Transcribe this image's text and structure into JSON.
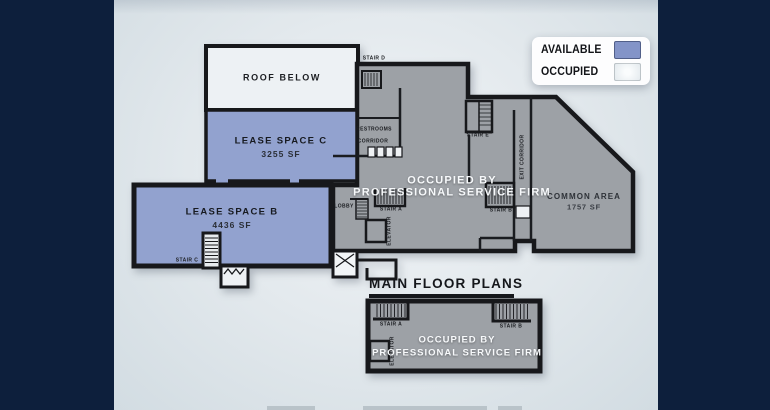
{
  "legend": {
    "items": [
      {
        "label": "AVAILABLE",
        "color": "#8394c8"
      },
      {
        "label": "OCCUPIED",
        "color": "#e7edf1"
      }
    ]
  },
  "main_plan": {
    "roof_label": "ROOF BELOW",
    "lease_space_c": {
      "name": "LEASE SPACE C",
      "area": "3255 SF",
      "status": "available"
    },
    "lease_space_b": {
      "name": "LEASE SPACE B",
      "area": "4436 SF",
      "status": "available"
    },
    "common_area": {
      "name": "COMMON AREA",
      "area": "1757 SF",
      "status": "occupied"
    },
    "occupied_by": {
      "line1": "OCCUPIED BY",
      "line2": "PROFESSIONAL SERVICE FIRM"
    },
    "rooms": {
      "stair_a": "STAIR A",
      "stair_b": "STAIR B",
      "stair_c": "STAIR C",
      "stair_d": "STAIR D",
      "stair_e": "STAIR E",
      "restrooms": "RESTROOMS",
      "corridor": "CORRIDOR",
      "exit_corridor": "EXIT CORRIDOR",
      "lobby": "LOBBY",
      "elevator": "ELEVATOR"
    }
  },
  "lower_plan": {
    "title": "MAIN FLOOR PLANS",
    "occupied_by": {
      "line1": "OCCUPIED BY",
      "line2": "PROFESSIONAL SERVICE FIRM"
    },
    "rooms": {
      "stair_a": "STAIR A",
      "stair_b": "STAIR B",
      "elevator": "ELEVATOR"
    }
  },
  "colors": {
    "available_fill": "#92a2cf",
    "occupied_fill": "#9da1a6",
    "frame_navy": "#0d1f3c",
    "wall_black": "#17181b"
  }
}
